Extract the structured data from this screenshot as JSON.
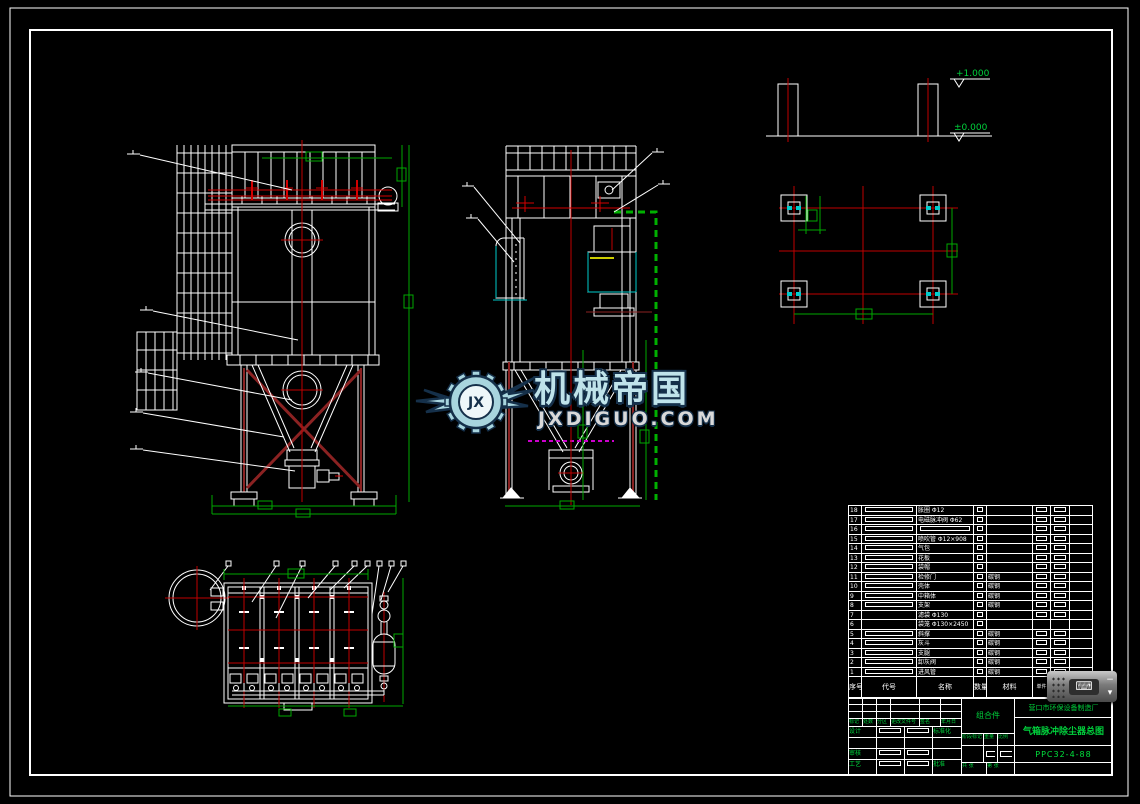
{
  "colors": {
    "line_white": "#ffffff",
    "centerline_red": "#cc0000",
    "brace_maroon": "#8b2222",
    "dimension_green": "#00a800",
    "text_green": "#00d23c",
    "duct_cyan": "#00cccc",
    "flange_magenta": "#cc00cc",
    "gasket_yellow": "#cccc00",
    "logo_blue": "#bfe3ea",
    "logo_outline": "#15304a"
  },
  "elevations": {
    "top": "+1.000",
    "base": "±0.000"
  },
  "watermark": {
    "brand": "机械帝国",
    "site": "JXDIGUO.COM",
    "monogram": "JX"
  },
  "widget": {
    "minimize": "−",
    "expand": "▾"
  },
  "title_block": {
    "company": "营口市环保设备制造厂",
    "drawing_title": "气箱脉冲除尘器总图",
    "drawing_no": "PPC32-4-88",
    "assembly": "组合件",
    "bom_headers": [
      "序号",
      "代号",
      "名称",
      "数量",
      "材料",
      "单件",
      "总计",
      "备注"
    ],
    "bom_rows": [
      [
        "18",
        "□",
        "胀圈 Φ12",
        "□",
        "",
        "□",
        "□",
        ""
      ],
      [
        "17",
        "□",
        "电磁脉冲阀 Φ62",
        "□",
        "",
        "□",
        "□",
        ""
      ],
      [
        "16",
        "□",
        "□",
        "□",
        "",
        "□",
        "□",
        ""
      ],
      [
        "15",
        "□",
        "喷吹管 Φ12×908",
        "□",
        "",
        "□",
        "□",
        ""
      ],
      [
        "14",
        "□",
        "气包",
        "□",
        "",
        "□",
        "□",
        ""
      ],
      [
        "13",
        "□",
        "花板",
        "□",
        "",
        "□",
        "□",
        ""
      ],
      [
        "12",
        "□",
        "袋帽",
        "□",
        "",
        "□",
        "□",
        ""
      ],
      [
        "11",
        "□",
        "检修门",
        "□",
        "碳钢",
        "□",
        "□",
        ""
      ],
      [
        "10",
        "□",
        "壳体",
        "□",
        "碳钢",
        "□",
        "□",
        ""
      ],
      [
        "9",
        "□",
        "中箱体",
        "□",
        "碳钢",
        "□",
        "□",
        ""
      ],
      [
        "8",
        "□",
        "支架",
        "□",
        "碳钢",
        "□",
        "□",
        ""
      ],
      [
        "7",
        "",
        "滤袋 Φ130",
        "□",
        "",
        "□",
        "□",
        ""
      ],
      [
        "6",
        "",
        "袋笼 Φ130×2450",
        "□",
        "",
        "",
        "",
        ""
      ],
      [
        "5",
        "□",
        "斜撑",
        "□",
        "碳钢",
        "□",
        "□",
        ""
      ],
      [
        "4",
        "□",
        "灰斗",
        "□",
        "碳钢",
        "□",
        "□",
        ""
      ],
      [
        "3",
        "□",
        "支腿",
        "□",
        "碳钢",
        "□",
        "□",
        ""
      ],
      [
        "2",
        "□",
        "卸灰阀",
        "□",
        "碳钢",
        "□",
        "□",
        ""
      ],
      [
        "1",
        "□",
        "进风管",
        "□",
        "碳钢",
        "□",
        "□",
        ""
      ]
    ],
    "sig_header": [
      "标记",
      "处数",
      "分区",
      "更改文件号",
      "签名",
      "年月日"
    ],
    "sig_rows": [
      [
        "设计",
        "□",
        "□",
        "标准化"
      ],
      [
        "",
        "",
        "",
        ""
      ],
      [
        "审核",
        "□",
        "□",
        ""
      ],
      [
        "工艺",
        "□",
        "□",
        "批准"
      ]
    ],
    "stage_labels": [
      "阶段标记",
      "重量",
      "比例"
    ],
    "sheet_labels": [
      "共 张",
      "第 张"
    ]
  }
}
